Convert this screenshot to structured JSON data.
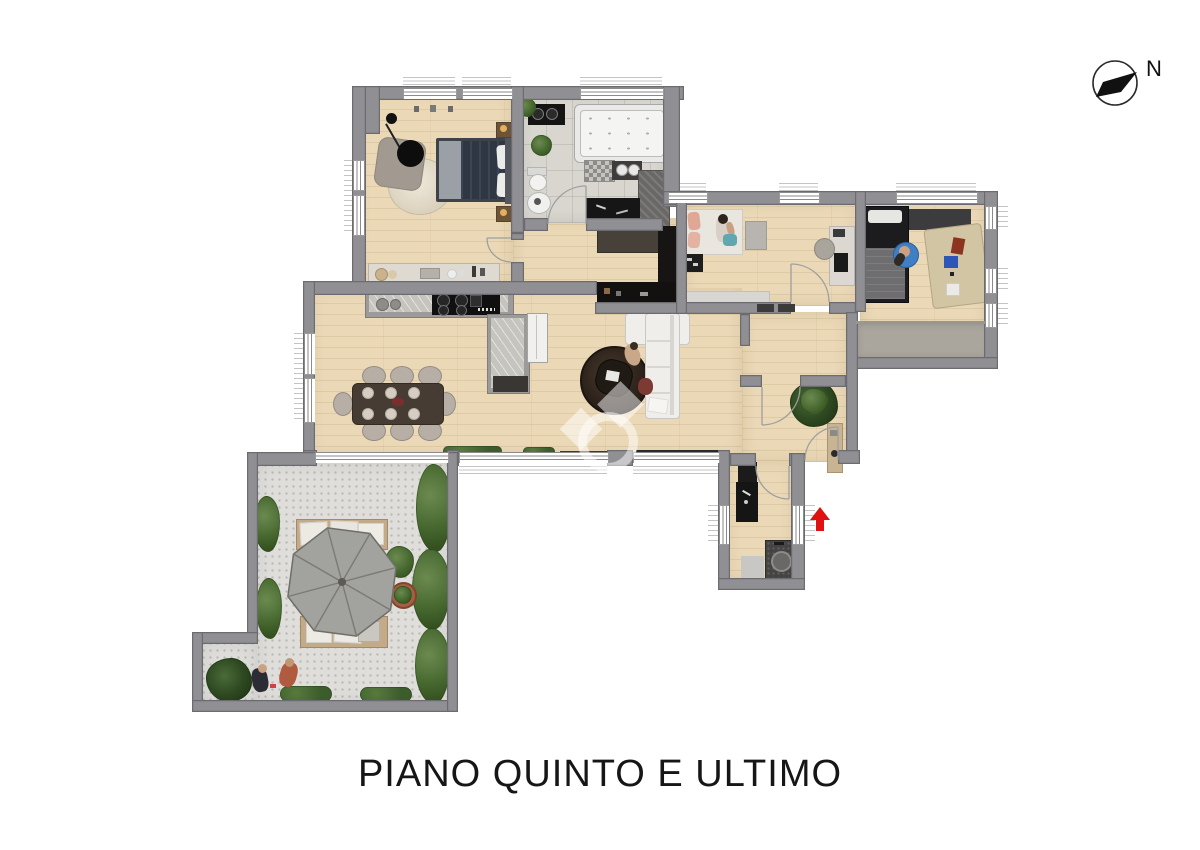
{
  "meta": {
    "width": 1200,
    "height": 850,
    "background": "#ffffff"
  },
  "title": {
    "text": "PIANO QUINTO E ULTIMO"
  },
  "compass": {
    "label": "N"
  },
  "palette": {
    "wall": "#908f93",
    "wall_edge": "#6c6b70",
    "wood": "#ead8b6",
    "tile": "#d8d6cf",
    "terrace": "#dfdedb",
    "balcony": "#aba69d",
    "plant_green": "#46682f",
    "accent_red": "#e01111",
    "black_furniture": "#141414",
    "white_fixture": "#f2f2f0",
    "umbrella": "#a2a29e"
  }
}
